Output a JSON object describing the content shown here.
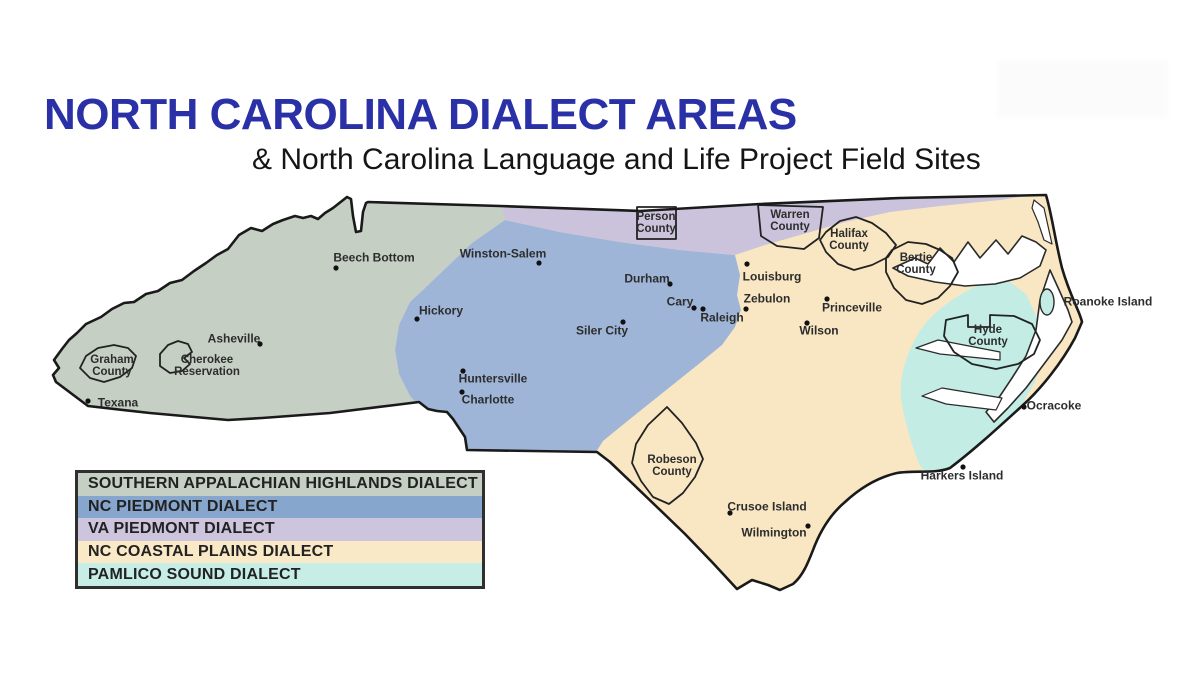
{
  "header": {
    "title": "NORTH CAROLINA DIALECT AREAS",
    "subtitle": "& North Carolina Language and Life Project Field Sites"
  },
  "legend": {
    "items": [
      {
        "label": "SOUTHERN APPALACHIAN HIGHLANDS DIALECT",
        "color": "#c5cfc3"
      },
      {
        "label": "NC PIEDMONT DIALECT",
        "color": "#86a6ce"
      },
      {
        "label": "VA PIEDMONT DIALECT",
        "color": "#ccc5dd"
      },
      {
        "label": "NC COASTAL PLAINS DIALECT",
        "color": "#fae9c6"
      },
      {
        "label": "PAMLICO SOUND DIALECT",
        "color": "#c6eee7"
      }
    ]
  },
  "map": {
    "region_colors": {
      "appalachian": "#c5cfc3",
      "nc_piedmont": "#9fb5d8",
      "va_piedmont": "#cac3db",
      "coastal_plains": "#f9e7c3",
      "pamlico_sound": "#c2ece4",
      "water": "#ffffff",
      "outline": "#1a1a1a"
    },
    "labels": [
      {
        "id": "beech-bottom",
        "text": "Beech Bottom"
      },
      {
        "id": "winston-salem",
        "text": "Winston-Salem"
      },
      {
        "id": "hickory",
        "text": "Hickory"
      },
      {
        "id": "durham",
        "text": "Durham"
      },
      {
        "id": "louisburg",
        "text": "Louisburg"
      },
      {
        "id": "cary",
        "text": "Cary"
      },
      {
        "id": "raleigh",
        "text": "Raleigh"
      },
      {
        "id": "zebulon",
        "text": "Zebulon"
      },
      {
        "id": "siler-city",
        "text": "Siler City"
      },
      {
        "id": "princeville",
        "text": "Princeville"
      },
      {
        "id": "wilson",
        "text": "Wilson"
      },
      {
        "id": "asheville",
        "text": "Asheville"
      },
      {
        "id": "texana",
        "text": "Texana"
      },
      {
        "id": "huntersville",
        "text": "Huntersville"
      },
      {
        "id": "charlotte",
        "text": "Charlotte"
      },
      {
        "id": "crusoe-island",
        "text": "Crusoe Island"
      },
      {
        "id": "wilmington",
        "text": "Wilmington"
      },
      {
        "id": "graham-county",
        "text": "Graham\nCounty"
      },
      {
        "id": "cherokee-reservation",
        "text": "Cherokee\nReservation"
      },
      {
        "id": "person-county",
        "text": "Person\nCounty"
      },
      {
        "id": "warren-county",
        "text": "Warren\nCounty"
      },
      {
        "id": "halifax-county",
        "text": "Halifax\nCounty"
      },
      {
        "id": "bertie-county",
        "text": "Bertie\nCounty"
      },
      {
        "id": "hyde-county",
        "text": "Hyde\nCounty"
      },
      {
        "id": "robeson-county",
        "text": "Robeson\nCounty"
      },
      {
        "id": "roanoke-island",
        "text": "Roanoke Island"
      },
      {
        "id": "ocracoke",
        "text": "Ocracoke"
      },
      {
        "id": "harkers-island",
        "text": "Harkers Island"
      }
    ]
  }
}
